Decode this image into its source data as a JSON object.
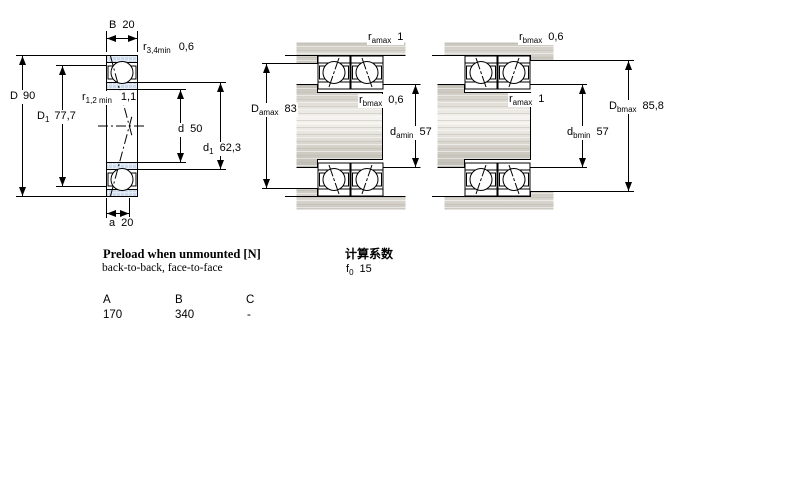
{
  "figures": {
    "single": {
      "description": "angular contact ball bearing cross-section",
      "labels": {
        "B": {
          "sym": "B",
          "sub": "",
          "value": "20"
        },
        "r34": {
          "sym": "r",
          "sub": "3,4min",
          "value": "0,6"
        },
        "D": {
          "sym": "D",
          "sub": "",
          "value": "90"
        },
        "D1": {
          "sym": "D",
          "sub": "1",
          "value": "77,7"
        },
        "r12": {
          "sym": "r",
          "sub": "1,2 min",
          "value": "1,1"
        },
        "d": {
          "sym": "d",
          "sub": "",
          "value": "50"
        },
        "d1": {
          "sym": "d",
          "sub": "1",
          "value": "62,3"
        },
        "a": {
          "sym": "a",
          "sub": "",
          "value": "20"
        }
      }
    },
    "pair_back_to_back": {
      "description": "mounted bearing pair with shaft and housing abutments",
      "labels": {
        "ramax": {
          "sym": "r",
          "sub": "amax",
          "value": "1"
        },
        "Damax": {
          "sym": "D",
          "sub": "amax",
          "value": "83"
        },
        "rbmax": {
          "sym": "r",
          "sub": "bmax",
          "value": "0,6"
        },
        "damin": {
          "sym": "d",
          "sub": "amin",
          "value": "57"
        }
      }
    },
    "pair_face_to_face": {
      "description": "mounted bearing pair with shaft and housing abutments",
      "labels": {
        "rbmax": {
          "sym": "r",
          "sub": "bmax",
          "value": "0,6"
        },
        "ramax": {
          "sym": "r",
          "sub": "amax",
          "value": "1"
        },
        "dbmin": {
          "sym": "d",
          "sub": "bmin",
          "value": "57"
        },
        "Dbmax": {
          "sym": "D",
          "sub": "bmax",
          "value": "85,8"
        }
      }
    }
  },
  "preload_table": {
    "title": "Preload when unmounted [N]",
    "subtitle": "back-to-back, face-to-face",
    "columns": [
      "A",
      "B",
      "C"
    ],
    "values": [
      "170",
      "340",
      "-"
    ]
  },
  "calculation": {
    "title": "计算系数",
    "factor": {
      "sym": "f",
      "sub": "0",
      "value": "15"
    }
  },
  "colors": {
    "ring_fill": "#cbd9ec",
    "steel_gray": "#d5d2cb",
    "line": "#000000"
  }
}
